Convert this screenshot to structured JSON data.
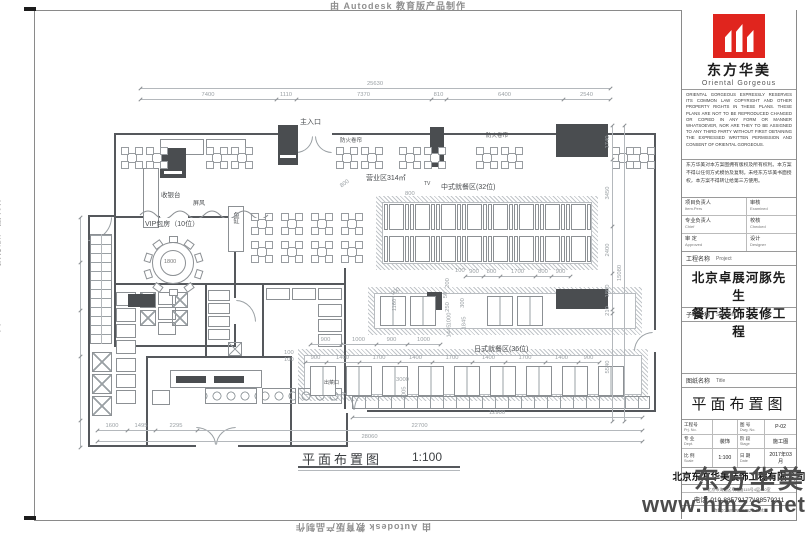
{
  "watermarks": {
    "autodesk": "由 Autodesk 教育版产品制作",
    "brand_name": "东方华美",
    "brand_site": "www.hmzs.net"
  },
  "title_block": {
    "logo_cn": "东方华美",
    "logo_en": "Oriental Gorgeous",
    "copyright_en": "ORIENTAL GORGEOUS EXPRESSLY RESERVES ITS COMMON LAW COPYRIGHT AND OTHER PROPERTY RIGHTS IN THESE PLANS. THESE PLANS ARE NOT TO BE REPRODUCED CHANGED OR COPIED IN ANY FORM OR MANNER WHATSOEVER, NOR ARE THEY TO BE ASSIGNED TO ANY THIRD PARTY WITHOUT FIRST OBTAINING THE EXPRESSED WRITTEN PERMISSION AND CONSENT OF ORIENTAL GORGEOUS.",
    "notes_cn": "东方华美对本方案图拥有版权及所有权利。本方案不得以任何方式模仿及复制。未经东方华美书面授权，本方案不得转让给第三方使用。",
    "personnel": [
      {
        "cn": "项目负责人",
        "en": "Item.Pers",
        "cn2": "审核",
        "en2": "Examined"
      },
      {
        "cn": "专业负责人",
        "en": "Chief",
        "cn2": "校核",
        "en2": "Checked"
      },
      {
        "cn": "审 定",
        "en": "Approved",
        "cn2": "设计",
        "en2": "Designer"
      }
    ],
    "project_label": "工程名称",
    "project_label_en": "Project",
    "project_name_1": "北京卓展河豚先生",
    "project_name_2": "餐厅装饰装修工程",
    "subitem_label": "子项名称",
    "subitem_label_en": "Sub Item",
    "sheet_label": "图纸名称",
    "sheet_label_en": "Title",
    "drawing_title": "平面布置图",
    "info": [
      {
        "cn": "工程号",
        "en": "Prj. No.",
        "val": "",
        "cn2": "图 号",
        "en2": "Dwg. No.",
        "val2": "P-02"
      },
      {
        "cn": "专 业",
        "en": "Dept.",
        "val": "装饰",
        "cn2": "阶 段",
        "en2": "Stage",
        "val2": "施工图"
      },
      {
        "cn": "比 例",
        "en": "Scale",
        "val": "1:100",
        "cn2": "日 期",
        "en2": "Date",
        "val2": "2017年03月"
      }
    ],
    "company": "北京东方华美装饰工程有限公司",
    "address": "北京市海淀区阜成路115号4层410室",
    "phone": "电话: 010-88579177\\\\88579211",
    "website": "http://www.hmzs.net"
  },
  "plan": {
    "labels": {
      "main_entrance": "主入口",
      "fire_shutter": "防火卷帘",
      "screen": "屏风",
      "biz_area": "营业区314㎡",
      "tv": "TV",
      "cn_dining": "中式就餐区(32位)",
      "vip_room": "VIP包房（10位）",
      "cashier": "收银台",
      "fish_tank": "鱼缸",
      "jp_dining": "日式就餐区(36位)",
      "food_pass": "出菜口",
      "table_dia": "1800",
      "caption": "平面布置图",
      "caption_scale": "1:100"
    },
    "dims": {
      "top_total": "25630",
      "top": [
        "7400",
        "1110",
        "7370",
        "810",
        "6400",
        "2540"
      ],
      "right_total": "15080",
      "right": [
        "1740",
        "3450",
        "2400",
        "1860",
        "210",
        "5540"
      ],
      "bottom": [
        "1600",
        "1495",
        "2295",
        "22700"
      ],
      "bottom_span": "12900",
      "bottom_total": "28060",
      "cn_top": "100",
      "cn_chain": [
        "900",
        "800",
        "1700",
        "800",
        "900"
      ],
      "jp_mid": [
        "900",
        "1000",
        "900",
        "1000"
      ],
      "jp_row2": [
        "900",
        "1400",
        "1700",
        "1400",
        "1700",
        "1400",
        "1700",
        "1400",
        "900"
      ],
      "v_left": [
        "200",
        "50",
        "250",
        "1000",
        "1445"
      ],
      "v_left2": [
        "300",
        "1845"
      ],
      "misc": [
        "800",
        "800",
        "900",
        "1160",
        "3000",
        "2005",
        "100",
        "100"
      ]
    }
  }
}
